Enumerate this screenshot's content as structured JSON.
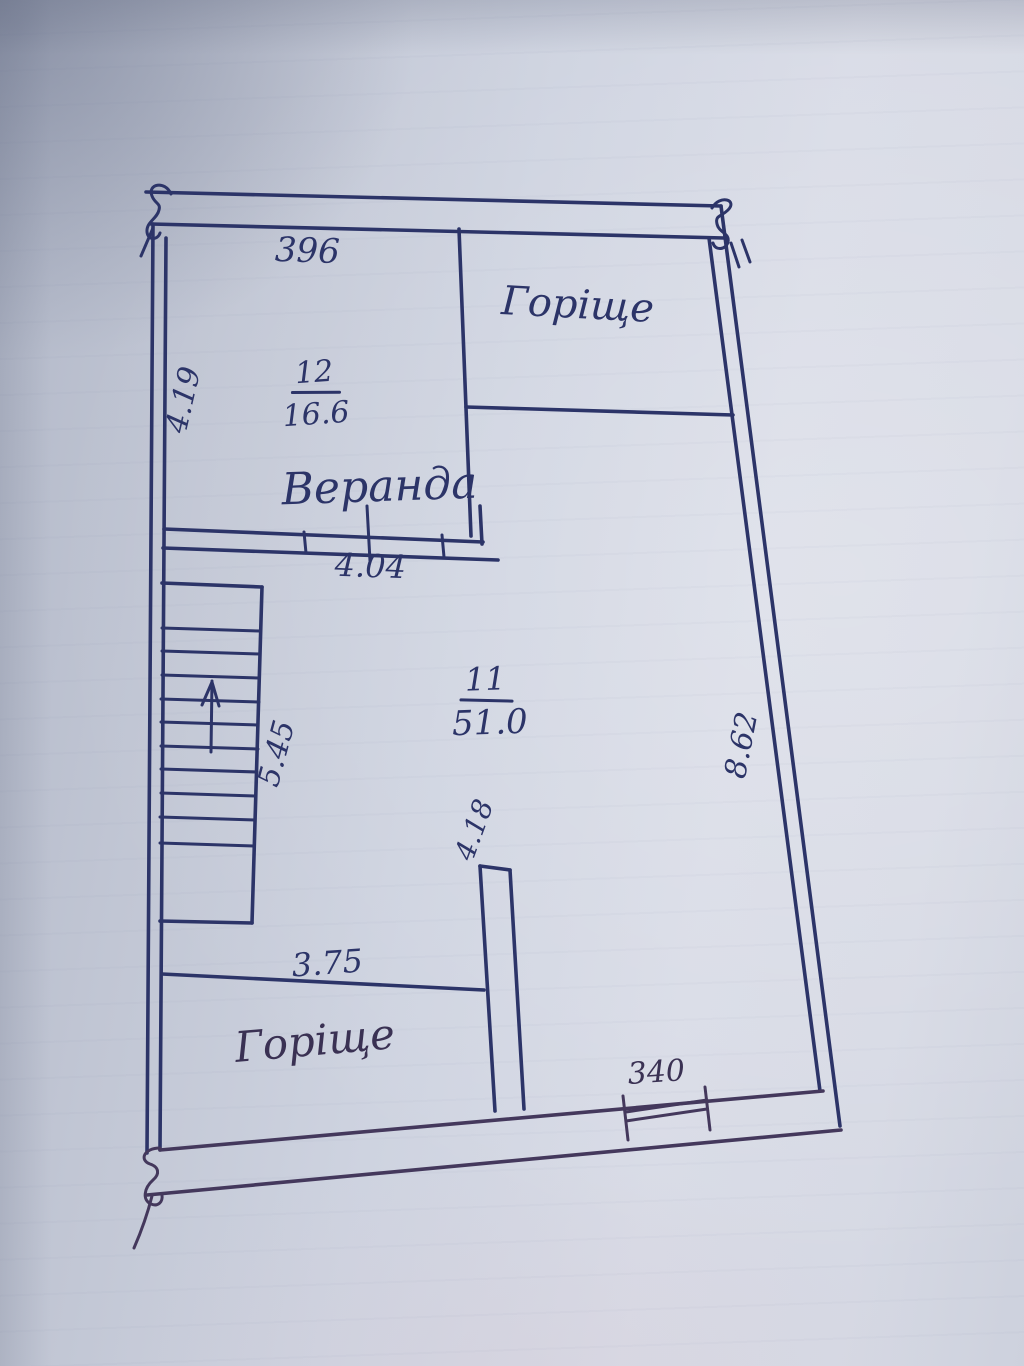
{
  "document_kind": "hand-drawn floor plan sketch",
  "colors": {
    "ink_blue": "#2c3468",
    "ink_violet": "#44385c",
    "paper": "#ced3e0"
  },
  "labels": {
    "attic_top": "Горіще",
    "attic_bottom": "Горіще",
    "veranda": "Веранда",
    "room12": {
      "number": "12",
      "area": "16.6"
    },
    "room11": {
      "number": "11",
      "area": "51.0"
    },
    "dims": {
      "top_width": "396",
      "left_height": "4.19",
      "veranda_width": "4.04",
      "stairs_height": "5.45",
      "partition_height": "4.18",
      "lower_width": "3.75",
      "right_height": "8.62",
      "window_width": "340"
    }
  }
}
